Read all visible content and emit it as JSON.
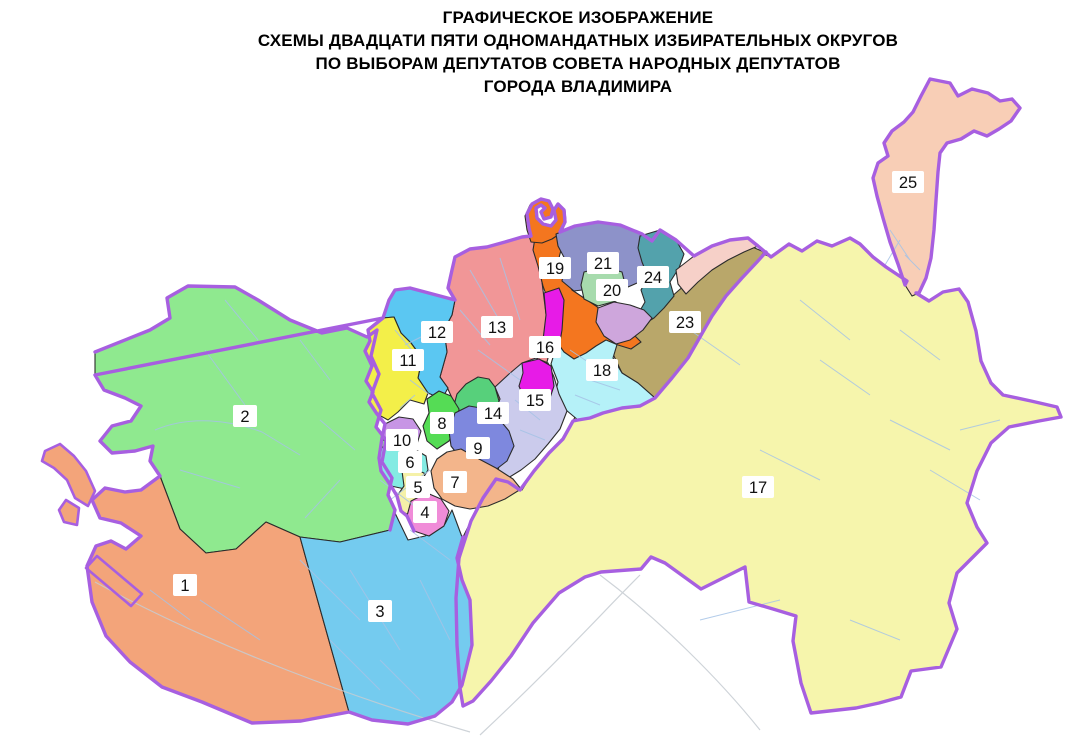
{
  "title": {
    "lines": [
      "ГРАФИЧЕСКОЕ ИЗОБРАЖЕНИЕ",
      "СХЕМЫ ДВАДЦАТИ ПЯТИ ОДНОМАНДАТНЫХ ИЗБИРАТЕЛЬНЫХ ОКРУГОВ",
      "ПО ВЫБОРАМ ДЕПУТАТОВ СОВЕТА НАРОДНЫХ ДЕПУТАТОВ",
      "ГОРОДА ВЛАДИМИРА"
    ]
  },
  "map": {
    "border_color": "#a75fe0",
    "district_border_color": "#2b2b2b",
    "street_color": "#a6c3e6",
    "label_bg": "#ffffff",
    "label_text_color": "#111111",
    "districts": [
      {
        "id": "17",
        "color": "#f6f5ac",
        "label": {
          "text": "17",
          "x": 758,
          "y": 487
        },
        "shapes": [
          "613,371 626,367 640,357 652,350 666,328 682,306 698,288 716,268 734,255 749,247 758,252 771,257 789,244 802,251 817,241 832,246 850,238 860,244 873,257 886,267 898,275 907,281 916,293 929,301 943,292 959,289 968,302 976,331 981,361 991,383 1003,395 1031,401 1057,407 1061,417 1039,421 1009,427 991,443 977,471 967,503 977,527 987,543 957,573 949,603 957,629 941,667 911,671 901,697 879,703 856,708 811,713 801,683 793,641 796,616 773,609 749,602 745,567 701,589 665,563 651,557 641,569 601,572 585,577 559,593 533,623 511,656 491,681 473,701 463,706 460,688 457,645 456,598 459,558 463,537 471,521 483,498 496,479 513,485 522,490 534,471 549,453 563,439 573,421 582,403 594,389 607,381"
        ]
      },
      {
        "id": "2",
        "color": "#8fe98f",
        "label": {
          "text": "2",
          "x": 245,
          "y": 416
        },
        "shapes": [
          "95,352 150,330 170,318 167,298 188,286 235,287 258,300 290,320 322,333 347,328 367,337 377,330 371,356 379,374 372,393 381,410 376,427 386,440 382,462 392,478 388,495 395,510 390,530 340,542 300,537 266,522 236,549 206,553 180,529 160,476 150,461 153,446 135,451 112,453 100,441 112,426 131,421 141,406 125,398 104,390 95,375"
        ]
      },
      {
        "id": "1",
        "color": "#f3a47a",
        "label": {
          "text": "1",
          "x": 185,
          "y": 585
        },
        "shapes": [
          "160,476 180,529 206,553 236,549 266,522 300,537 308,566 349,712 301,721 252,723 202,702 162,687 130,662 106,636 92,602 87,566 96,546 111,541 126,549 141,536 121,523 100,518 92,500 105,488 125,492 141,490",
          "45,451 60,444 74,456 86,471 95,491 88,506 75,498 67,480 54,468 42,461",
          "66,500 79,508 77,525 64,522 59,510",
          "97,556 142,594 131,606 86,568"
        ]
      },
      {
        "id": "3",
        "color": "#74cbef",
        "label": {
          "text": "3",
          "x": 380,
          "y": 611
        },
        "shapes": [
          "300,537 340,542 390,530 395,513 408,540 425,536 445,524 452,510 462,537 457,558 462,580 470,600 472,645 462,685 452,702 435,716 408,724 372,720 349,712 308,566"
        ]
      },
      {
        "id": "13",
        "color": "#f19697",
        "label": {
          "text": "13",
          "x": 497,
          "y": 327
        },
        "shapes": [
          "455,257 470,249 487,247 505,242 522,237 532,235 537,245 540,266 543,290 546,314 548,338 548,358 543,378 533,398 519,414 502,426 486,431 472,427 459,414 452,398 447,387 440,377 447,352 444,330 452,315 455,300 448,288 452,270"
        ]
      },
      {
        "id": "12",
        "color": "#5bc7f2",
        "label": {
          "text": "12",
          "x": 437,
          "y": 332
        },
        "shapes": [
          "383,318 389,300 395,290 410,288 425,292 440,296 455,300 452,315 444,330 447,352 440,377 448,388 442,399 428,393 418,378 422,358 411,343 401,333 394,317"
        ]
      },
      {
        "id": "11",
        "color": "#f3ef49",
        "label": {
          "text": "11",
          "x": 408,
          "y": 360
        },
        "shapes": [
          "368,330 377,322 383,318 394,317 401,333 411,343 422,358 418,378 428,393 424,404 410,400 398,412 388,420 377,414 369,402 373,392 366,381 372,366 365,351 370,341"
        ]
      },
      {
        "id": "23",
        "color": "#b9a76a",
        "label": {
          "text": "23",
          "x": 685,
          "y": 322
        },
        "shapes": [
          "623,320 612,352 622,373 638,383 655,398 672,378 688,358 700,337 712,316 726,296 742,278 757,262 764,252 750,246 734,250 718,258 702,270 686,284 670,298 654,310 637,316"
        ]
      },
      {
        "id": "18",
        "color": "#b5f1f8",
        "label": {
          "text": "18",
          "x": 602,
          "y": 370
        },
        "shapes": [
          "558,302 574,296 588,302 600,312 612,322 624,321 613,358 622,373 638,383 655,398 640,406 622,408 603,413 590,418 578,420 566,410 554,398 558,382 551,364 557,344 556,320"
        ]
      },
      {
        "id": "19",
        "color": "#f4761f",
        "label": {
          "text": "19",
          "x": 555,
          "y": 268
        },
        "shapes": [
          "535,238 556,232 562,246 558,262 565,278 572,290 584,298 596,306 608,316 620,325 632,333 641,342 631,349 618,345 606,340 596,346 586,353 574,359 564,352 554,338 547,320 549,303 543,286 538,266 533,250",
          "531,242 527,230 525,216 530,205 540,199 549,202 553,210 550,218 543,219 541,212 546,208 541,204 535,208 536,217 542,223 551,225 556,219 553,210 558,203 565,210 566,222 561,233 552,239 542,243"
        ]
      },
      {
        "id": "21",
        "color": "#8d92c9",
        "label": {
          "text": "21",
          "x": 603,
          "y": 263
        },
        "shapes": [
          "556,234 575,226 598,222 620,225 642,234 652,241 648,256 652,268 644,280 628,287 608,291 590,289 574,291 562,281 566,261 558,246"
        ]
      },
      {
        "id": "24",
        "color": "#53a2ac",
        "label": {
          "text": "24",
          "x": 653,
          "y": 277
        },
        "shapes": [
          "640,236 660,230 676,240 684,254 679,268 670,282 674,296 664,308 654,318 644,324 638,314 645,302 641,290 648,277 642,262 638,248"
        ]
      },
      {
        "id": "20",
        "color": "#a7dbad",
        "label": {
          "text": "20",
          "x": 612,
          "y": 290
        },
        "shapes": [
          "584,272 604,267 622,272 626,288 616,301 598,306 584,299 581,285"
        ]
      },
      {
        "id": "unlabeled-lavender-area",
        "color": "#cea6dc",
        "shapes": [
          "598,308 614,302 630,305 644,310 652,318 643,330 630,340 616,344 604,336 596,322"
        ]
      },
      {
        "id": "unlabeled-pink-area",
        "color": "#f6d0c8",
        "shapes": [
          "676,270 694,256 712,246 730,240 748,238 758,246 744,252 728,260 712,270 698,282 686,294 678,284"
        ]
      },
      {
        "id": "25",
        "color": "#f8ceb6",
        "label": {
          "text": "25",
          "x": 908,
          "y": 182
        },
        "shapes": [
          "930,79 950,83 958,96 972,89 988,93 1000,101 1012,99 1020,108 1011,121 999,129 987,136 974,131 961,139 947,143 940,153 938,172 936,200 934,230 931,258 926,278 919,293 912,296 905,285 898,264 890,242 883,218 877,196 873,178 878,163 888,156 884,143 892,131 904,122 913,112 921,96"
        ]
      },
      {
        "id": "15",
        "color": "#cbcbec",
        "label": {
          "text": "15",
          "x": 535,
          "y": 400
        },
        "shapes": [
          "495,387 509,374 522,363 536,358 548,363 554,377 559,394 567,411 560,429 548,444 535,459 521,470 508,478 498,470 502,455 495,441 500,426 495,411 500,399"
        ]
      },
      {
        "id": "16",
        "color": "#e71be7",
        "label": {
          "text": "16",
          "x": 545,
          "y": 347
        },
        "shapes": [
          "544,293 559,288 564,300 562,330 558,354 548,357 543,340 546,315",
          "522,363 539,359 551,366 554,386 549,401 537,409 525,401 519,386 523,373"
        ]
      },
      {
        "id": "14",
        "color": "#57d07b",
        "label": {
          "text": "14",
          "x": 493,
          "y": 413
        },
        "shapes": [
          "457,394 466,384 478,377 489,379 495,387 499,401 494,416 499,431 491,446 481,453 473,446 468,431 461,419 453,409"
        ]
      },
      {
        "id": "8",
        "color": "#55dc55",
        "label": {
          "text": "8",
          "x": 442,
          "y": 423
        },
        "shapes": [
          "427,399 439,391 451,396 459,409 457,426 449,441 437,449 427,441 423,426 429,413"
        ]
      },
      {
        "id": "9",
        "color": "#7e88de",
        "label": {
          "text": "9",
          "x": 478,
          "y": 448
        },
        "shapes": [
          "455,413 469,406 487,409 499,419 509,431 514,446 507,461 494,471 477,466 461,459 451,446 449,431"
        ]
      },
      {
        "id": "7",
        "color": "#f3b58b",
        "label": {
          "text": "7",
          "x": 455,
          "y": 482
        },
        "shapes": [
          "431,471 437,459 447,452 461,449 479,459 496,468 513,479 521,489 505,499 488,506 470,509 455,506 442,499 434,488"
        ]
      },
      {
        "id": "10",
        "color": "#c795e5",
        "label": {
          "text": "10",
          "x": 402,
          "y": 440
        },
        "shapes": [
          "385,424 399,417 413,419 421,431 417,444 404,450 391,448 382,438"
        ]
      },
      {
        "id": "6",
        "color": "#84ebe3",
        "label": {
          "text": "6",
          "x": 410,
          "y": 462
        },
        "shapes": [
          "382,447 391,448 404,452 416,450 426,456 428,470 420,483 405,489 391,486 381,471 379,458"
        ]
      },
      {
        "id": "5",
        "color": "#f5f1a8",
        "label": {
          "text": "5",
          "x": 418,
          "y": 487
        },
        "shapes": [
          "402,471 414,469 424,473 427,489 421,506 411,516 401,511 397,496 404,486"
        ]
      },
      {
        "id": "4",
        "color": "#f08cd8",
        "label": {
          "text": "4",
          "x": 425,
          "y": 512
        },
        "shapes": [
          "411,501 427,493 441,499 449,511 444,526 429,536 414,531 407,516"
        ]
      }
    ]
  }
}
